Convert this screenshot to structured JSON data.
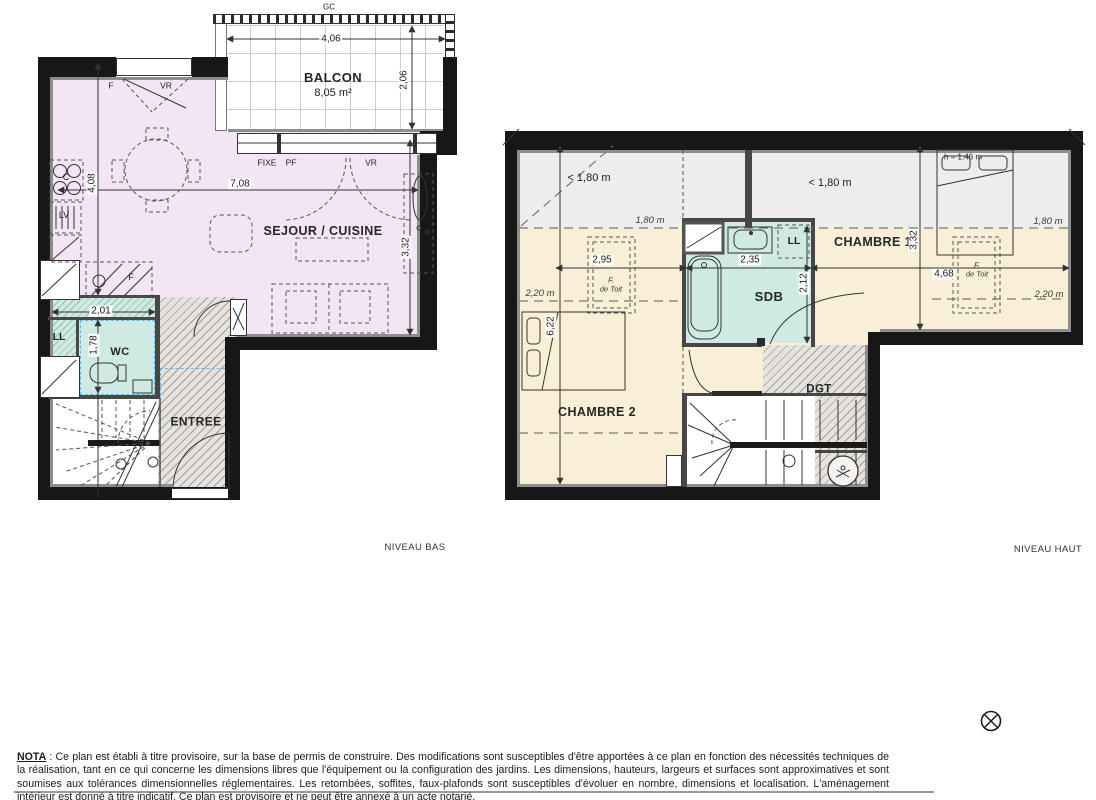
{
  "page": {
    "background": "#ffffff"
  },
  "colors": {
    "sejour_fill": "#f4e5f5",
    "wet_room_fill": "#cfeae3",
    "bedroom_fill": "#f9efd6",
    "low_ceiling_fill": "#ededed",
    "circulation_hatch": "#e6e2de",
    "wall": "#171717",
    "blue_zone_dash": "#6ab2e2"
  },
  "niveau_bas": {
    "title": "NIVEAU BAS",
    "balcony": {
      "label": "BALCON",
      "area": "8,05 m²",
      "guardrail": "GC",
      "width": "4,06",
      "depth": "2,06"
    },
    "rooms": {
      "sejour_cuisine": "SEJOUR / CUISINE",
      "wc": "WC",
      "entree": "ENTREE"
    },
    "openings": {
      "window_f": "F",
      "window_vr": "VR",
      "bay_fixe": "FIXE",
      "bay_pf": "PF",
      "bay_vr": "VR"
    },
    "equipment": {
      "hob": "C",
      "dishwasher": "LV",
      "fridge": "F",
      "washing_machine": "LL"
    },
    "dims": {
      "sejour_width": "7,08",
      "sejour_height": "4,08",
      "sejour_right_height": "3,32",
      "wc_width": "2,01",
      "wc_height": "1,78"
    }
  },
  "niveau_haut": {
    "title": "NIVEAU HAUT",
    "rooms": {
      "chambre1": "CHAMBRE 1",
      "chambre2": "CHAMBRE 2",
      "sdb": "SDB",
      "dgt": "DGT"
    },
    "equipment": {
      "washing_machine": "LL"
    },
    "ceiling": {
      "under_180_left": "< 1,80 m",
      "under_180_right": "< 1,80 m",
      "line_180_left": "1,80 m",
      "line_180_right": "1,80 m",
      "line_220_left": "2,20 m",
      "line_220_right": "2,20 m",
      "bed_height": "h = 1,46 m"
    },
    "roof_windows": {
      "left": "F.\nde Toit",
      "right": "F.\nde Toit"
    },
    "dims": {
      "total_height": "6,22",
      "chambre1_height": "3,32",
      "sdb_height": "2,12",
      "chambre2_width": "2,95",
      "sdb_width": "2,35",
      "chambre1_width": "4,68"
    }
  },
  "footer": {
    "nota_label": "NOTA",
    "nota_text": " : Ce plan est établi à titre provisoire, sur la base de permis de construire. Des modifications sont susceptibles d'être apportées à ce plan en fonction des nécessités techniques de la réalisation, tant en ce qui concerne les dimensions libres que l'équipement ou la configuration des jardins. Les dimensions, hauteurs, largeurs et surfaces sont approximatives et sont soumises aux tolérances dimensionnelles réglementaires. Les retombées, soffites, faux-plafonds sont susceptibles d'évoluer en nombre, dimensions et localisation. L'aménagement intérieur est donné à titre indicatif. Ce plan est provisoire et ne peut être annexé à un acte notarié."
  }
}
